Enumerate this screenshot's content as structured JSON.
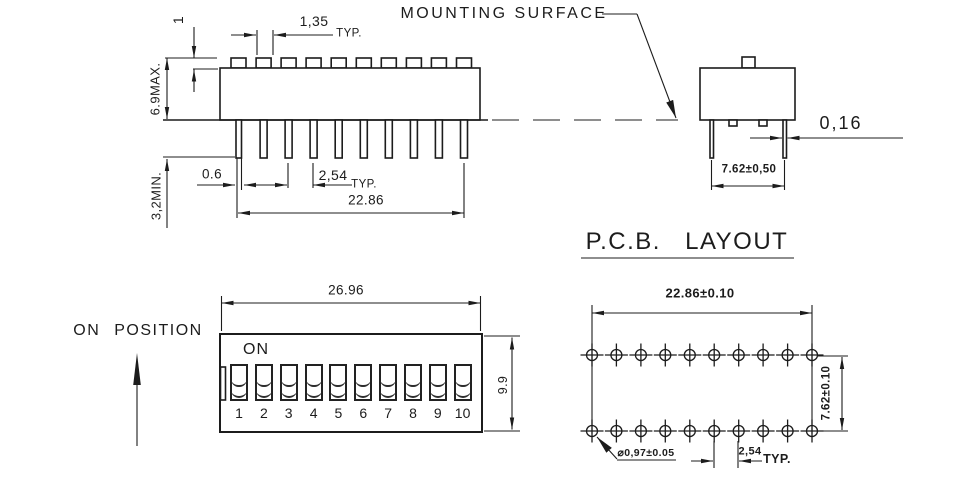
{
  "drawing": {
    "side_view": {
      "labels": {
        "actuator_height": "1",
        "actuator_width": "1,35",
        "actuator_width_typ": "TYP.",
        "max_height": "6.9MAX.",
        "pin_min_length": "3,2MIN.",
        "pin_width": "0.6",
        "pin_pitch": "2,54",
        "pin_pitch_typ": "TYP.",
        "pin_span": "22.86"
      }
    },
    "end_view": {
      "labels": {
        "mounting_surface": "MOUNTING SURFACE",
        "pin_thickness": "0,16",
        "pin_row_spacing": "7.62±0,50"
      }
    },
    "front_view": {
      "labels": {
        "on_position": "ON POSITION",
        "on": "ON",
        "overall_width": "26.96",
        "overall_height": "9.9"
      },
      "switch_numbers": [
        "1",
        "2",
        "3",
        "4",
        "5",
        "6",
        "7",
        "8",
        "9",
        "10"
      ]
    },
    "pcb_layout": {
      "labels": {
        "title": "P.C.B. LAYOUT",
        "hole_span": "22.86±0.10",
        "row_spacing": "7.62±0.10",
        "hole_diameter": "⌀0,97±0.05",
        "hole_pitch": "2,54",
        "hole_pitch_typ": "TYP."
      },
      "holes_per_row": 10,
      "rows": 2
    },
    "colors": {
      "line": "#1c1c1c",
      "background": "#ffffff"
    }
  }
}
